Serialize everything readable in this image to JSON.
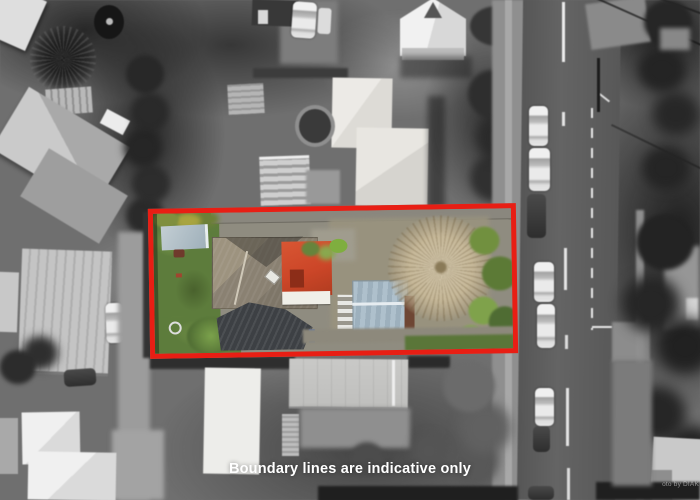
{
  "overlay": {
    "disclaimer": "Boundary lines are indicative only",
    "watermark": "oto by DIAK"
  },
  "colors": {
    "boundary_red": "#e81e14",
    "lawn_green": "#5d7c3c",
    "red_roof": "#cc4628",
    "garage_blue": "#aec0cc",
    "tree_tan": "#c6b899",
    "roof_taupe": "#90877a",
    "roof_dark": "#3d4044"
  },
  "scene": {
    "type": "aerial-photograph",
    "highlight": "single property shown in colour, surroundings in black and white",
    "boundary_style": "red rectangle outline"
  }
}
